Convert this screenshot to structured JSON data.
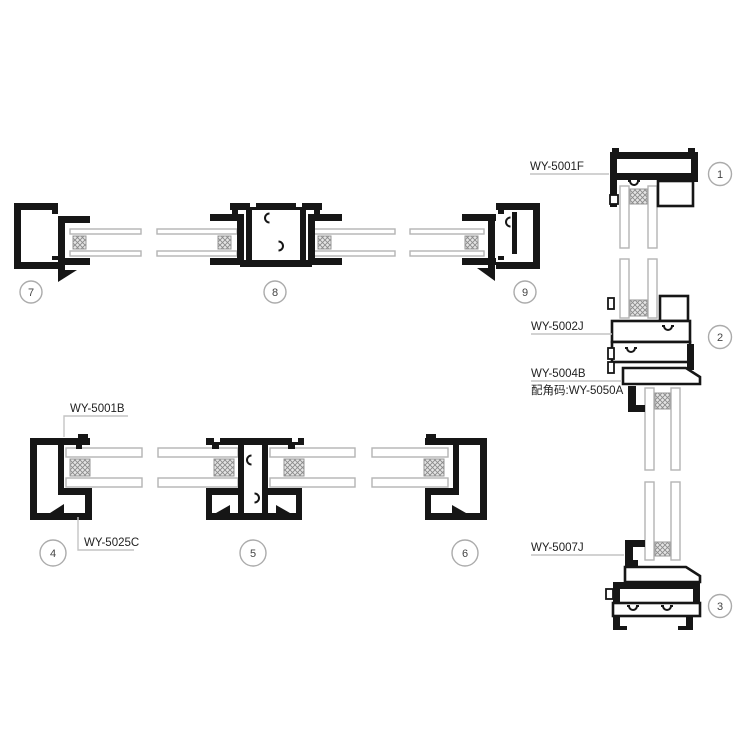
{
  "colors": {
    "profile_line": "#161616",
    "glass_line": "#b4b4b4",
    "leader_line": "#c4c4c4",
    "callout_circle": "#ababab",
    "spacer_fill": "#e4e4e4",
    "spacer_hatch": "#8b8b8b",
    "label_text": "#222222"
  },
  "labels": {
    "head_profile": "WY-5001F",
    "transom_profile": "WY-5002J",
    "transom_lower_profile": "WY-5004B",
    "corner_code": "配角码:WY-5050A",
    "sill_bead_profile": "WY-5007J",
    "frame_profile": "WY-5001B",
    "glazing_bead_profile": "WY-5025C"
  },
  "callouts": {
    "c1": "1",
    "c2": "2",
    "c3": "3",
    "c4": "4",
    "c5": "5",
    "c6": "6",
    "c7": "7",
    "c8": "8",
    "c9": "9"
  }
}
